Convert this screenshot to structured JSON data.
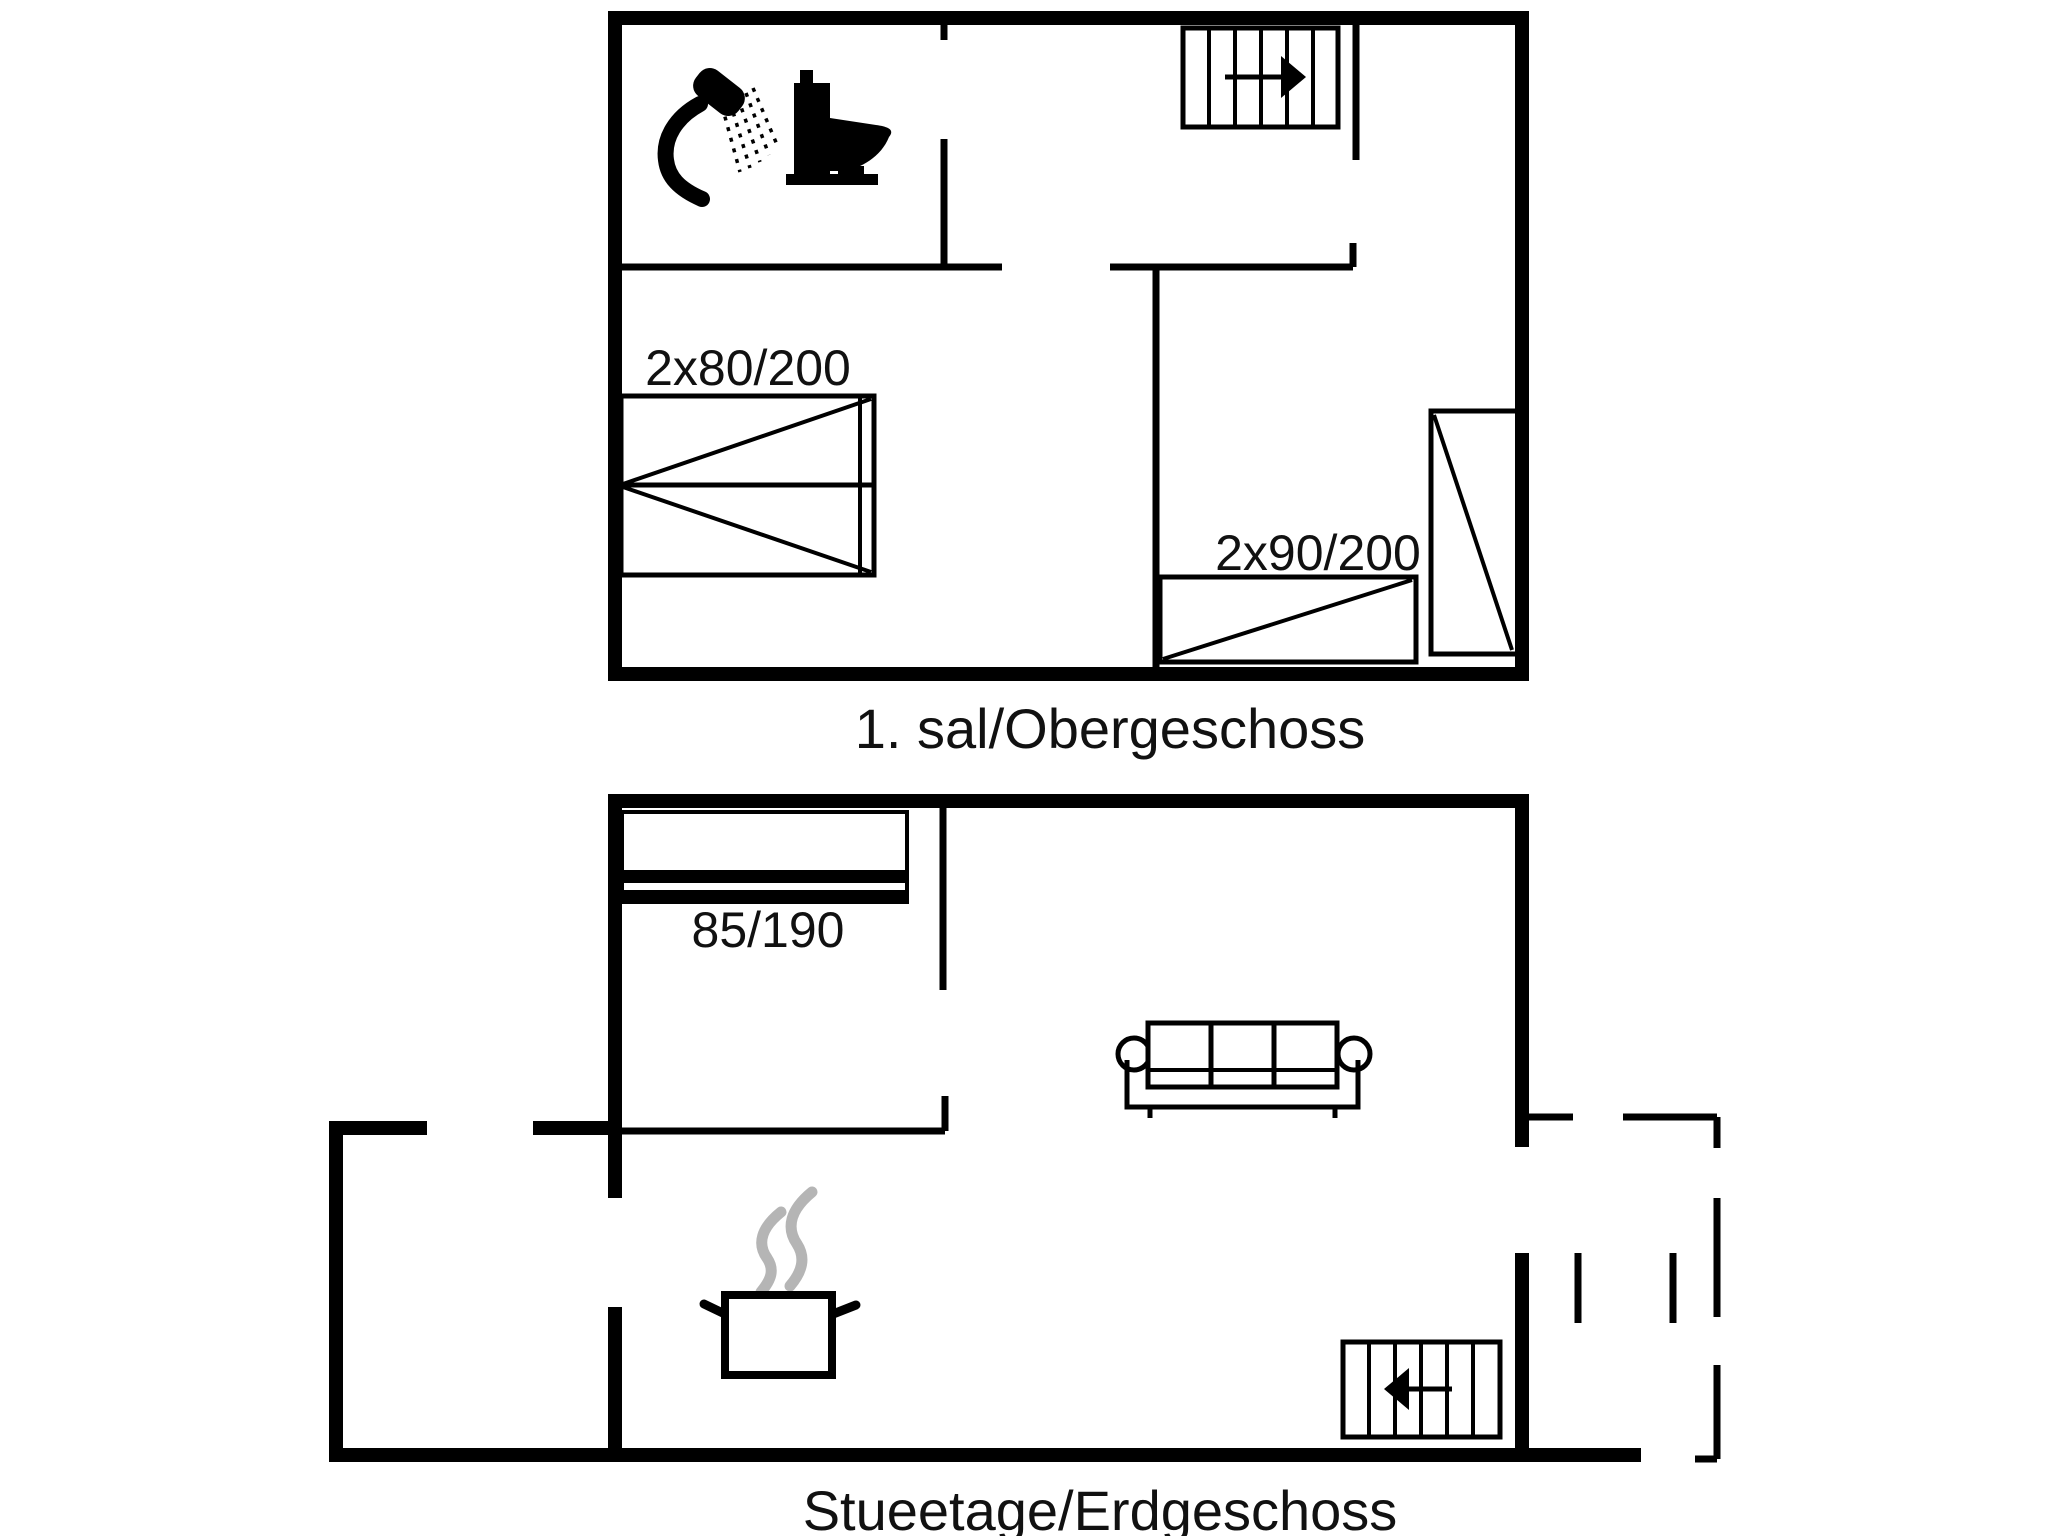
{
  "page": {
    "background_color": "#ffffff",
    "line_color": "#000000",
    "steam_color": "#b5b5b5",
    "text_color": "#111111"
  },
  "floor1": {
    "label": "1. sal/Obergeschoss",
    "double_bed_label": "2x80/200",
    "twin_bed_label": "2x90/200",
    "icons": {
      "shower": "shower-icon",
      "toilet": "toilet-icon",
      "stairs_direction": "arrow-right-icon"
    }
  },
  "floor0": {
    "label": "Stueetage/Erdgeschoss",
    "bed_label": "85/190",
    "icons": {
      "sofa": "sofa-icon",
      "cooking_pot": "cooking-pot-icon",
      "steam": "steam-icon",
      "stairs_direction": "arrow-left-icon"
    }
  }
}
